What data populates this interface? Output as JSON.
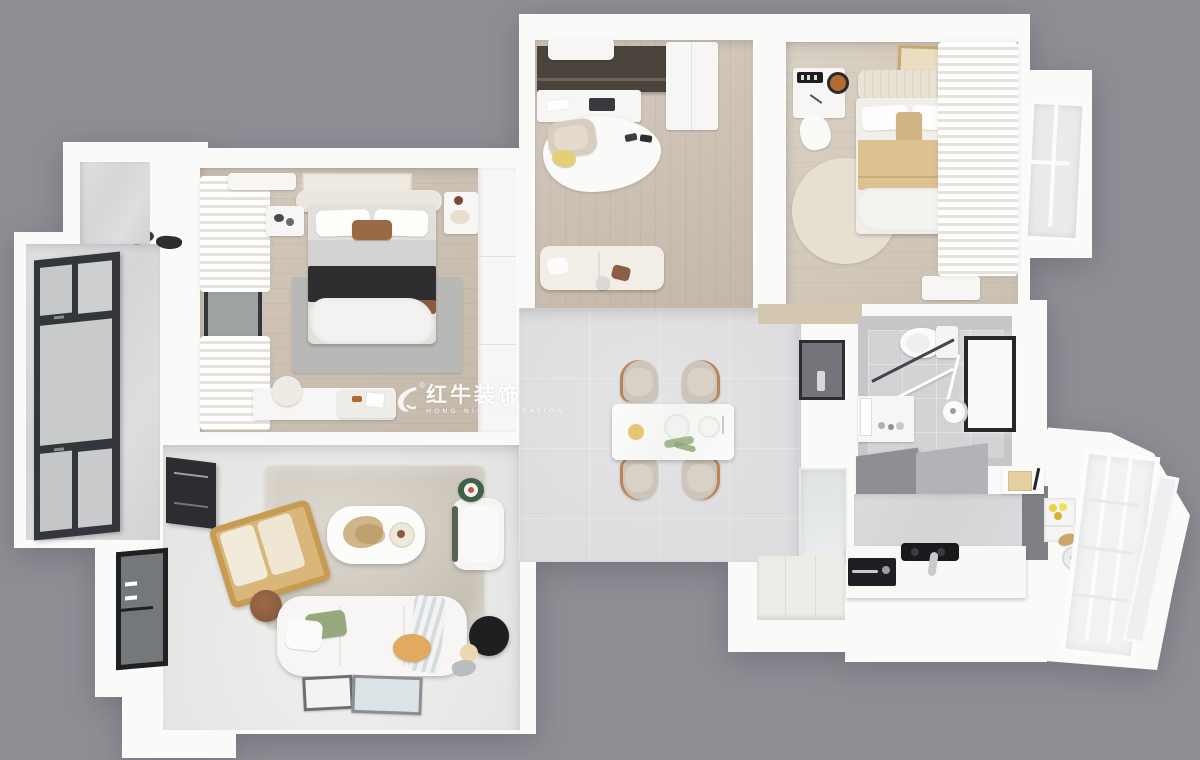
{
  "scene": {
    "description": "Photorealistic 3D top-down floor plan render of a three-bedroom apartment",
    "view": "top-down axonometric",
    "background_color": "#8E8E95"
  },
  "watermark": {
    "brand_cn": "红牛装饰",
    "brand_en": "HONG NIU DECORATION",
    "registered": "®",
    "icon": "bull-logo-icon",
    "color": "#FFFFFF"
  },
  "palette": {
    "bg": "#8E8E95",
    "wall": "#FAFAF9",
    "wood-floor": "#CBBFB0",
    "tile-floor": "#DDDDE0",
    "bath-tile": "#C7C7C9",
    "window-frame": "#33363A",
    "curtain-fold": "#E5E2DB",
    "rug-gray": "#B8B8B6",
    "rug-taupe": "#D2CCC2",
    "pillow-green": "#96A87C",
    "blanket-tan": "#DDC191",
    "blanket-black": "#2E2E30",
    "pouf-orange": "#E2A960",
    "lemon-yellow": "#E7D33F",
    "wood-accent": "#C69B52",
    "table-brown": "#8A5C3F",
    "lamp-black": "#1F1F22",
    "watermark-white": "#FFFFFF"
  },
  "rooms": [
    {
      "id": "master-bedroom",
      "floor": "light wood",
      "items": [
        "double bed with black and brown throw",
        "gray area rug",
        "two nightstands",
        "air conditioner",
        "wall art",
        "vanity desk with stool",
        "white curtains",
        "built-in wardrobe"
      ]
    },
    {
      "id": "study",
      "floor": "light wood",
      "items": [
        "dark wall cabinet with desk",
        "air conditioner",
        "beige desk chair",
        "yellow ottoman",
        "organic white rug",
        "cream loveseat",
        "wardrobe"
      ]
    },
    {
      "id": "bedroom-2",
      "floor": "light wood",
      "items": [
        "double bed with tan blanket",
        "round beige rug",
        "desk with clock and lamp",
        "gold framed artwork",
        "white curtains",
        "bench"
      ]
    },
    {
      "id": "bathroom",
      "floor": "gray tile",
      "items": [
        "toilet",
        "glass shower enclosure",
        "shower set",
        "black framed window",
        "vanity with mirror"
      ]
    },
    {
      "id": "dining-room",
      "floor": "gray tile",
      "items": [
        "white marble dining table",
        "four beige chairs",
        "tableware",
        "plant sprig"
      ]
    },
    {
      "id": "hallway",
      "floor": "gray tile",
      "items": [
        "display niche",
        "glass cabinet"
      ]
    },
    {
      "id": "kitchen",
      "floor": "gray tile",
      "items": [
        "L-shaped white counter",
        "black cooktop",
        "built-in oven",
        "gray upper cabinets",
        "marble backsplash",
        "shelf with lemons",
        "bread and jar"
      ]
    },
    {
      "id": "living-room",
      "floor": "light gray tile",
      "items": [
        "three-seat white sofa",
        "green pillow",
        "striped throw",
        "orange pouf",
        "black disc floor lamp",
        "white armchair",
        "green side table",
        "wood lounge chair",
        "round brown side table",
        "white coffee table with dried plant",
        "taupe shag rug",
        "leaning picture frames",
        "black framed windows"
      ]
    },
    {
      "id": "balcony-left",
      "floor": "stone",
      "items": [
        "floor-to-ceiling black framed glazing",
        "drying rack"
      ]
    },
    {
      "id": "balcony-right",
      "floor": "white",
      "items": [
        "white railing glazing"
      ]
    },
    {
      "id": "entry",
      "floor": "white",
      "items": [
        "entry door"
      ]
    }
  ]
}
